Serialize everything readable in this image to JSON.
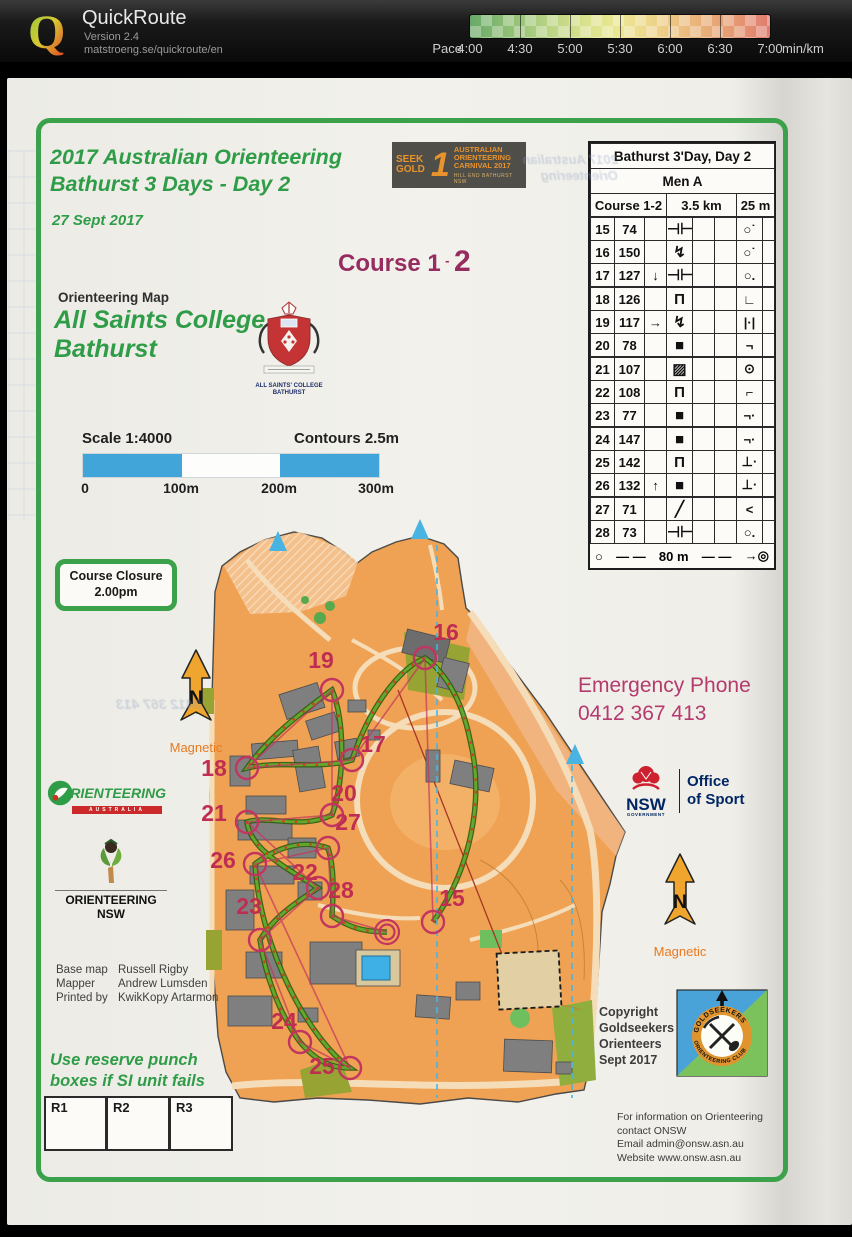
{
  "colors": {
    "accent_green": "#2f9c48",
    "magenta": "#962c60",
    "control_magenta": "#bf2e52",
    "scalebar_blue": "#41a5d9",
    "map_orange": "#efa253",
    "route_green": "#63a82c",
    "pace_gradient_ends": [
      "#69a967",
      "#e17c6f"
    ]
  },
  "app": {
    "title": "QuickRoute",
    "version": "Version 2.4",
    "url": "matstroeng.se/quickroute/en",
    "logo_letter": "Q",
    "legend": {
      "label": "Pace",
      "unit": "min/km",
      "ticks": [
        "4:00",
        "4:30",
        "5:00",
        "5:30",
        "6:00",
        "6:30",
        "7:00"
      ]
    }
  },
  "event": {
    "title1": "2017 Australian Orienteering",
    "title2": "Bathurst 3 Days - Day 2",
    "date": "27 Sept 2017",
    "course": "Course 1",
    "course_sep": "-",
    "course_overprint": "2"
  },
  "carnival": {
    "seek": "SEEK",
    "gold": "GOLD",
    "numeral": "1",
    "line1": "AUSTRALIAN",
    "line2": "ORIENTEERING",
    "line3": "CARNIVAL 2017",
    "venue": "HILL END  BATHURST  NSW"
  },
  "map_info": {
    "kind": "Orienteering Map",
    "name1": "All Saints College",
    "name2": "Bathurst",
    "scale": "Scale 1:4000",
    "contours": "Contours 2.5m",
    "bar_labels": [
      "0",
      "100m",
      "200m",
      "300m"
    ]
  },
  "college": {
    "line1": "ALL SAINTS' COLLEGE",
    "line2": "BATHURST"
  },
  "closure": {
    "line1": "Course Closure",
    "line2": "2.00pm"
  },
  "emergency": {
    "label": "Emergency Phone",
    "phone": "0412 367 413"
  },
  "north": {
    "letter": "N",
    "label": "Magnetic"
  },
  "oa_logo": {
    "word": "RIENTEERING",
    "sub": "AUSTRALIA"
  },
  "onsw_logo": {
    "label": "ORIENTEERING NSW"
  },
  "nsw_logo": {
    "abbr": "NSW",
    "gov": "GOVERNMENT",
    "office1": "Office",
    "office2": "of Sport"
  },
  "goldseekers": {
    "arc_top": "GOLDSEEKERS",
    "arc_bottom": "ORIENTEERING CLUB"
  },
  "copyright": {
    "line1": "Copyright",
    "line2": "Goldseekers",
    "line3": "Orienteers",
    "line4": "Sept 2017"
  },
  "contact": {
    "line1": "For information on Orienteering",
    "line2": "contact ONSW",
    "line3": "Email admin@onsw.asn.au",
    "line4": "Website www.onsw.asn.au"
  },
  "credits": {
    "rows": [
      {
        "k": "Base map",
        "v": "Russell Rigby"
      },
      {
        "k": "Mapper",
        "v": "Andrew Lumsden"
      },
      {
        "k": "Printed by",
        "v": "KwikKopy Artarmon"
      }
    ]
  },
  "reserve": {
    "line1": "Use reserve punch",
    "line2": "boxes if SI unit fails"
  },
  "punch_boxes": [
    "R1",
    "R2",
    "R3"
  ],
  "control_card": {
    "title": "Bathurst 3'Day, Day 2",
    "klass": "Men A",
    "course": "Course 1-2",
    "length": "3.5 km",
    "climb": "25 m",
    "rows": [
      {
        "no": "15",
        "code": "74",
        "c": "",
        "f": "⊣⊢",
        "p": "○˙"
      },
      {
        "no": "16",
        "code": "150",
        "c": "",
        "f": "↯",
        "p": "○˙"
      },
      {
        "no": "17",
        "code": "127",
        "c": "↓",
        "f": "⊣⊢",
        "p": "○."
      },
      {
        "no": "18",
        "code": "126",
        "c": "",
        "f": "Π",
        "p": "∟"
      },
      {
        "no": "19",
        "code": "117",
        "c": "→",
        "f": "↯",
        "p": "|·|"
      },
      {
        "no": "20",
        "code": "78",
        "c": "",
        "f": "■",
        "p": "¬"
      },
      {
        "no": "21",
        "code": "107",
        "c": "",
        "f": "▨",
        "p": "⊙"
      },
      {
        "no": "22",
        "code": "108",
        "c": "",
        "f": "Π",
        "p": "⌐"
      },
      {
        "no": "23",
        "code": "77",
        "c": "",
        "f": "■",
        "p": "¬·"
      },
      {
        "no": "24",
        "code": "147",
        "c": "",
        "f": "■",
        "p": "¬·"
      },
      {
        "no": "25",
        "code": "142",
        "c": "",
        "f": "Π",
        "p": "⊥·"
      },
      {
        "no": "26",
        "code": "132",
        "c": "↑",
        "f": "■",
        "p": "⊥·"
      },
      {
        "no": "27",
        "code": "71",
        "c": "",
        "f": "╱",
        "p": "<"
      },
      {
        "no": "28",
        "code": "73",
        "c": "",
        "f": "⊣⊢",
        "p": "○."
      }
    ],
    "finish_distance": "80 m"
  },
  "course_controls": [
    {
      "n": "15",
      "cx": 433,
      "cy": 922,
      "tx": 452,
      "ty": 906
    },
    {
      "n": "16",
      "cx": 425,
      "cy": 658,
      "tx": 446,
      "ty": 640
    },
    {
      "n": "17",
      "cx": 352,
      "cy": 760,
      "tx": 373,
      "ty": 752
    },
    {
      "n": "18",
      "cx": 247,
      "cy": 768,
      "tx": 214,
      "ty": 776
    },
    {
      "n": "19",
      "cx": 332,
      "cy": 690,
      "tx": 321,
      "ty": 668
    },
    {
      "n": "20",
      "cx": 332,
      "cy": 815,
      "tx": 344,
      "ty": 801
    },
    {
      "n": "21",
      "cx": 247,
      "cy": 822,
      "tx": 214,
      "ty": 821
    },
    {
      "n": "22",
      "cx": 318,
      "cy": 888,
      "tx": 305,
      "ty": 880
    },
    {
      "n": "23",
      "cx": 260,
      "cy": 940,
      "tx": 249,
      "ty": 914
    },
    {
      "n": "24",
      "cx": 300,
      "cy": 1042,
      "tx": 284,
      "ty": 1029
    },
    {
      "n": "25",
      "cx": 350,
      "cy": 1068,
      "tx": 322,
      "ty": 1074
    },
    {
      "n": "26",
      "cx": 255,
      "cy": 864,
      "tx": 223,
      "ty": 868
    },
    {
      "n": "27",
      "cx": 328,
      "cy": 848,
      "tx": 348,
      "ty": 830
    },
    {
      "n": "28",
      "cx": 332,
      "cy": 916,
      "tx": 341,
      "ty": 898
    }
  ],
  "finish": {
    "cx": 387,
    "cy": 932
  }
}
